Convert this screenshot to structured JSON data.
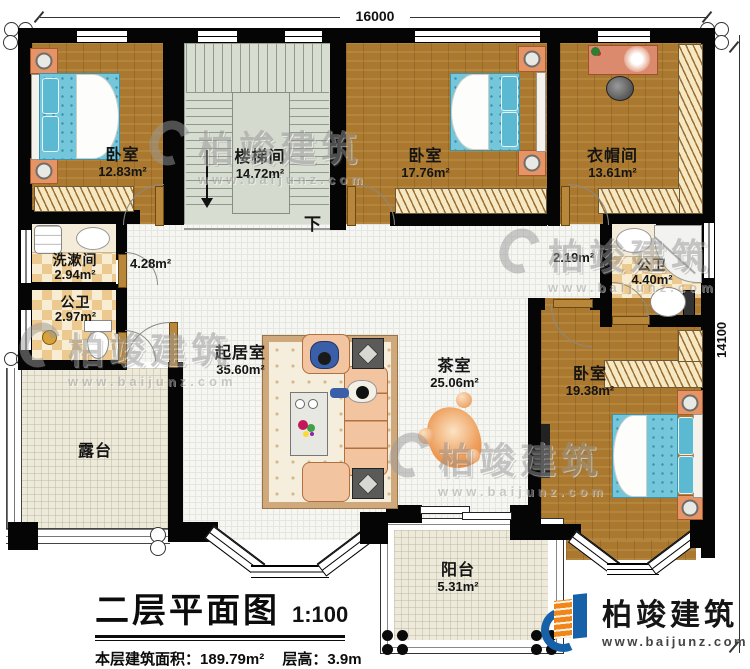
{
  "dimensions": {
    "top": "16000",
    "right": "14100"
  },
  "rooms": {
    "bedroom_top_left": {
      "name": "卧室",
      "area": "12.83m²"
    },
    "stairwell": {
      "name": "楼梯间",
      "area": "14.72m²",
      "down_label": "下"
    },
    "bedroom_top_middle": {
      "name": "卧室",
      "area": "17.76m²"
    },
    "cloakroom": {
      "name": "衣帽间",
      "area": "13.61m²"
    },
    "washroom": {
      "name": "洗漱间",
      "area": "2.94m²"
    },
    "toilet_left": {
      "name": "公卫",
      "area": "2.97m²"
    },
    "hall_left": {
      "area": "4.28m²"
    },
    "hall_right": {
      "area": "2.19m²"
    },
    "bathroom_right": {
      "name": "公卫",
      "area": "4.40m²"
    },
    "living_room": {
      "name": "起居室",
      "area": "35.60m²"
    },
    "tea_room": {
      "name": "茶室",
      "area": "25.06m²"
    },
    "bedroom_bottom_right": {
      "name": "卧室",
      "area": "19.38m²"
    },
    "terrace": {
      "name": "露台"
    },
    "balcony": {
      "name": "阳台",
      "area": "5.31m²"
    }
  },
  "title_block": {
    "title": "二层平面图",
    "scale": "1:100",
    "area_label": "本层建筑面积：",
    "area_value": "189.79m²",
    "height_label": "层高：",
    "height_value": "3.9m"
  },
  "brand": {
    "name": "柏竣建筑",
    "website": "www.baijunz.com"
  },
  "watermark": {
    "name": "柏竣建筑",
    "website": "www.baijunz.com"
  },
  "colors": {
    "wall": "#050505",
    "wood_floor": "#aa782f",
    "stair_floor": "#d8ddd1",
    "tile_light": "#f8ecd2",
    "tile_dark": "#ecc98e",
    "terrace_floor": "#edeadb",
    "bed": "#74c7da",
    "sofa": "#f2c5a0",
    "nightstand": "#e69465",
    "logo_blue": "#1661a8",
    "logo_orange": "#f08519"
  }
}
